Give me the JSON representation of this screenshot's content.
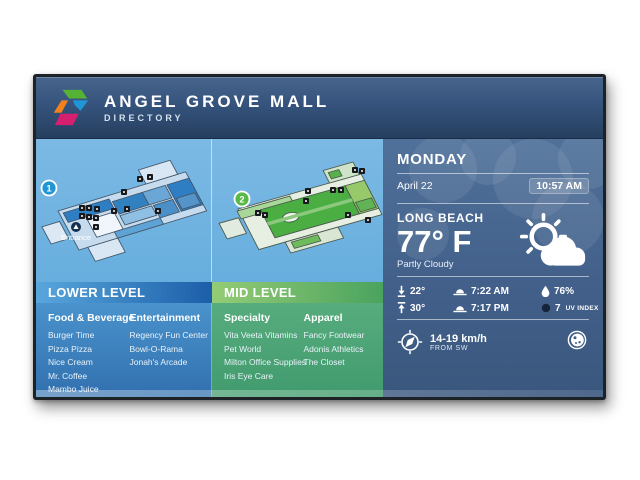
{
  "header": {
    "title": "ANGEL GROVE MALL",
    "subtitle": "DIRECTORY"
  },
  "lower": {
    "badge": "1",
    "entrance_label": "Entrance",
    "section_title": "LOWER LEVEL",
    "col1": {
      "heading": "Food & Beverage",
      "items": [
        "Burger Time",
        "Pizza Pizza",
        "Nice Cream",
        "Mr. Coffee",
        "Mambo Juice"
      ]
    },
    "col2": {
      "heading": "Entertainment",
      "items": [
        "Regency Fun Center",
        "Bowl-O-Rama",
        "Jonah's Arcade"
      ]
    }
  },
  "mid": {
    "badge": "2",
    "section_title": "MID LEVEL",
    "col1": {
      "heading": "Specialty",
      "items": [
        "Vita Veeta Vitamins",
        "Pet World",
        "Milton Office Supplies",
        "Iris Eye Care"
      ]
    },
    "col2": {
      "heading": "Apparel",
      "items": [
        "Fancy Footwear",
        "Adonis Athletics",
        "The Closet"
      ]
    }
  },
  "weather": {
    "day": "MONDAY",
    "date": "April 22",
    "time": "10:57 AM",
    "city": "LONG BEACH",
    "temperature": "77° F",
    "condition": "Partly Cloudy",
    "low": "22°",
    "high": "30°",
    "sunrise": "7:22 AM",
    "sunset": "7:17 PM",
    "humidity": "76%",
    "uv_value": "7",
    "uv_label": "UV INDEX",
    "wind_speed": "14-19 km/h",
    "wind_from": "FROM SW"
  },
  "colors": {
    "header_navy": "#2e4a6e",
    "lower_blue": "#1c5ea9",
    "mid_green": "#4aa35e",
    "sky_blue": "#6db2e2",
    "weather_panel": "#42608a"
  }
}
